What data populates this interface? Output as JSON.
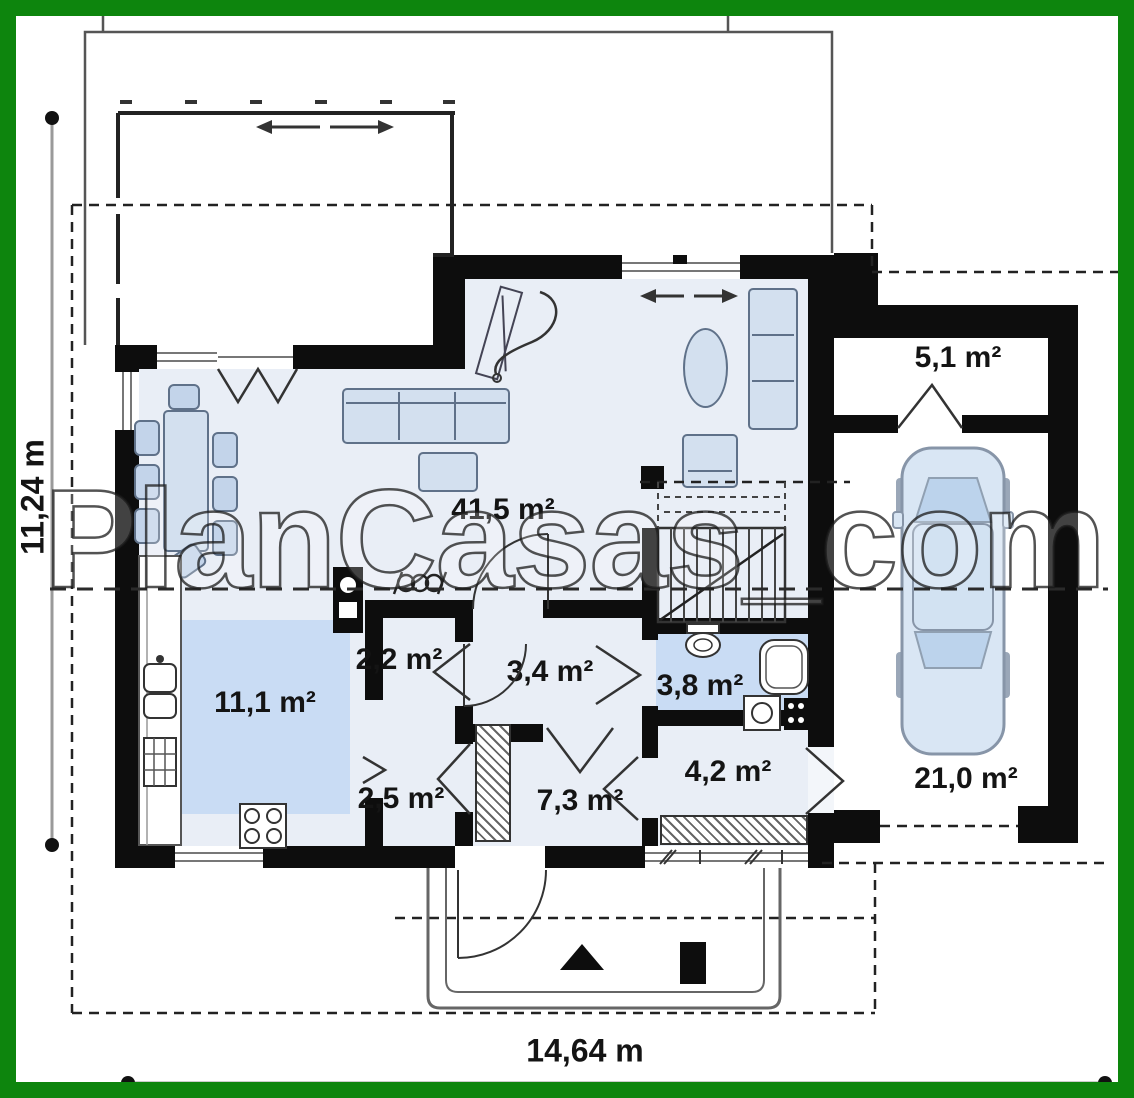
{
  "watermark": {
    "text": "PlanCasas_com"
  },
  "dimensions": {
    "height_label": "11,24 m",
    "width_label": "14,64 m"
  },
  "rooms": {
    "living": "41,5 m²",
    "storage": "5,1 m²",
    "kitchen": "11,1 m²",
    "pantry": "2,2 m²",
    "hall": "3,4 m²",
    "bathroom": "3,8 m²",
    "corridor": "2,5 m²",
    "vestibule": "7,3 m²",
    "hall2": "4,2 m²",
    "garage": "21,0 m²"
  },
  "colors": {
    "border_green": "#0d850d",
    "wall_black": "#0d0d0d",
    "floor_tint": "#e9eef6",
    "room_highlight": "#c9dcf4",
    "furniture_fill": "#d3e0ef"
  }
}
